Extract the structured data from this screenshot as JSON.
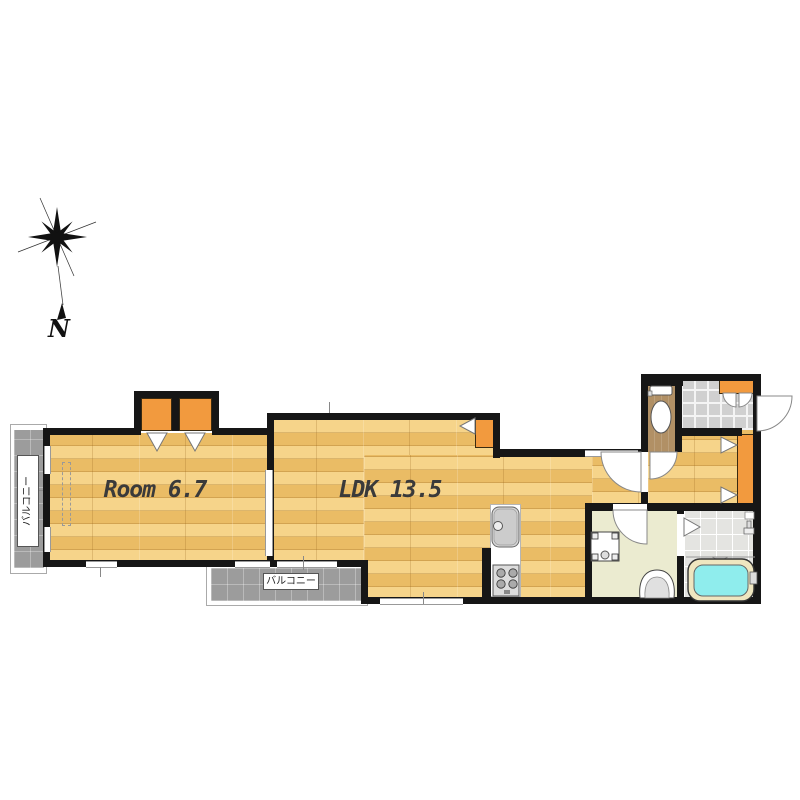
{
  "page": {
    "background": "#ffffff",
    "type": "apartment floor plan"
  },
  "compass": {
    "north_label": "N"
  },
  "floorplan": {
    "labels": {
      "room": "Room 6.7",
      "ldk": "LDK 13.5",
      "balcony_left": "バルコニー",
      "balcony_bottom": "バルコニー"
    },
    "rooms": [
      {
        "id": "room",
        "label": "Room 6.7",
        "floor": "wood"
      },
      {
        "id": "ldk",
        "label": "LDK 13.5",
        "floor": "wood"
      },
      {
        "id": "balcony_left",
        "label": "バルコニー",
        "floor": "concrete"
      },
      {
        "id": "balcony_bottom",
        "label": "バルコニー",
        "floor": "concrete"
      },
      {
        "id": "toilet_room",
        "floor": "brown"
      },
      {
        "id": "entrance_genkan",
        "floor": "tile"
      },
      {
        "id": "hallway",
        "floor": "wood"
      },
      {
        "id": "washroom",
        "floor": "pale"
      },
      {
        "id": "bathroom",
        "floor": "tile"
      }
    ],
    "fixtures": [
      "compass-rose",
      "toilet",
      "shoe-cabinet",
      "entry-door",
      "closet-folding-doors",
      "sliding-door",
      "kitchen-sink",
      "gas-stove",
      "washing-machine-pan",
      "washbasin",
      "bathtub",
      "shower-faucet"
    ],
    "colors": {
      "wall": "#161616",
      "wood_floor": "#efc470",
      "closet_orange": "#f29a3e",
      "balcony_gray": "#9c9c9c",
      "toilet_floor": "#b19065",
      "washroom_floor": "#ebebd0",
      "bath_tile": "#e4e4e1",
      "genkan_tile": "#d0d0d0",
      "bathtub_water": "#8feded",
      "label_text": "#3a3a3a"
    }
  }
}
